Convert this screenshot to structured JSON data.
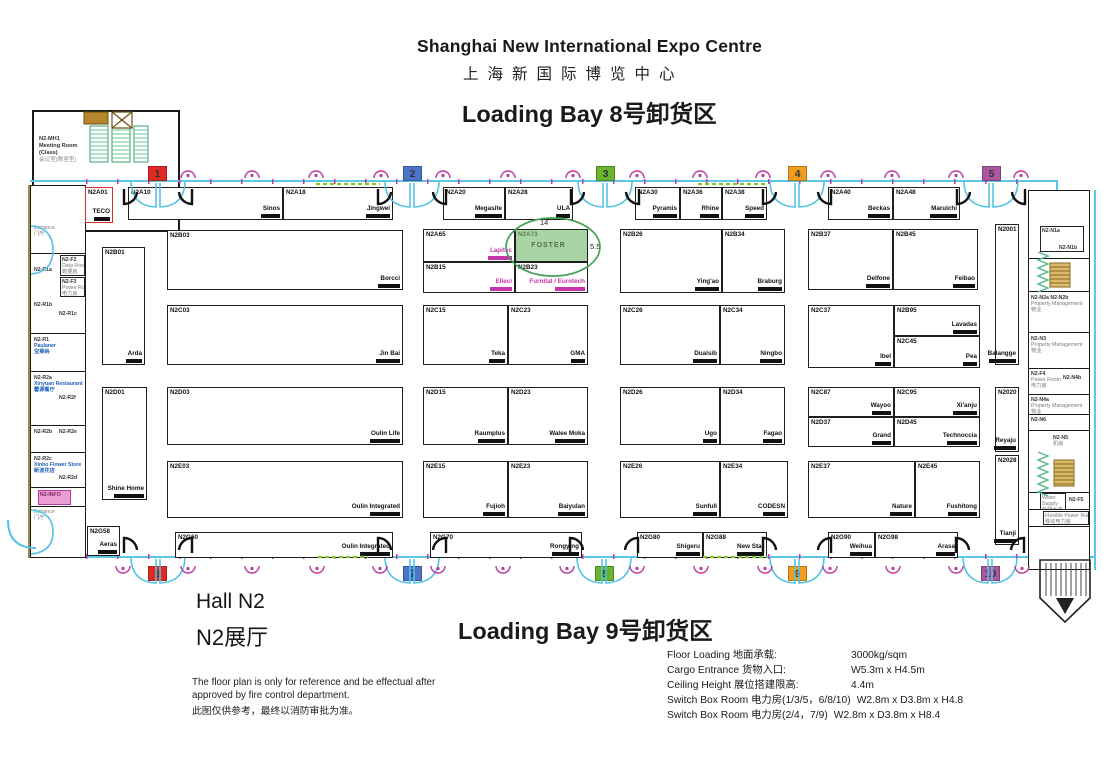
{
  "header": {
    "title_en": "Shanghai New International Expo Centre",
    "title_cn": "上海新国际博览中心",
    "bay_top": "Loading Bay 8号卸货区",
    "bay_bottom": "Loading Bay 9号卸货区"
  },
  "hall": {
    "en": "Hall N2",
    "cn": "N2展厅"
  },
  "disclaimer": {
    "en1": "The floor plan is only for reference and be effectual after",
    "en2": "approved by fire control department.",
    "cn": "此图仅供参考，最终以消防审批为准。"
  },
  "specs": [
    {
      "label": "Floor Loading 地面承载:",
      "value": "3000kg/sqm"
    },
    {
      "label": "Cargo Entrance 货物入口:",
      "value": "W5.3m x H4.5m"
    },
    {
      "label": "Ceiling Height 展位搭建限高:",
      "value": "4.4m"
    },
    {
      "label": "Switch Box Room 电力房(1/3/5，6/8/10)",
      "value": "W2.8m x D3.8m x H4.8"
    },
    {
      "label": "Switch Box Room 电力房(2/4，7/9)",
      "value": "W2.8m x D3.8m x H8.4"
    }
  ],
  "highlight": {
    "booth": "N2A73",
    "exhibitor": "FOSTER",
    "width_label": "14",
    "depth_label": "5.5",
    "ellipse_color": "#44a054"
  },
  "meeting_room": {
    "id": "N2-MH1",
    "line1": "Meeting Room",
    "line2": "(Class)",
    "line3": "会议室(教室型)"
  },
  "markers": [
    {
      "n": "1",
      "x": 148,
      "y": 166,
      "color": "#e02a23"
    },
    {
      "n": "2",
      "x": 403,
      "y": 166,
      "color": "#4d76c8"
    },
    {
      "n": "3",
      "x": 596,
      "y": 166,
      "color": "#69b52f"
    },
    {
      "n": "4",
      "x": 788,
      "y": 166,
      "color": "#f29d1f"
    },
    {
      "n": "5",
      "x": 982,
      "y": 166,
      "color": "#aa57a0"
    },
    {
      "n": "6",
      "x": 148,
      "y": 566,
      "color": "#e02a23"
    },
    {
      "n": "7",
      "x": 403,
      "y": 566,
      "color": "#4d76c8"
    },
    {
      "n": "8",
      "x": 595,
      "y": 566,
      "color": "#69b52f"
    },
    {
      "n": "9",
      "x": 788,
      "y": 566,
      "color": "#f29d1f"
    },
    {
      "n": "10",
      "x": 981,
      "y": 566,
      "color": "#aa57a0"
    }
  ],
  "booths": [
    {
      "id": "N2A01",
      "name": "TECO",
      "x": 85,
      "y": 187,
      "w": 28,
      "h": 36,
      "border": "#d03028"
    },
    {
      "id": "N2A10",
      "name": "Sinos",
      "x": 128,
      "y": 187,
      "w": 155,
      "h": 33
    },
    {
      "id": "N2A18",
      "name": "Jingwei",
      "x": 283,
      "y": 187,
      "w": 110,
      "h": 33
    },
    {
      "id": "N2A20",
      "name": "Megasite",
      "x": 443,
      "y": 187,
      "w": 62,
      "h": 33
    },
    {
      "id": "N2A28",
      "name": "ULA",
      "x": 505,
      "y": 187,
      "w": 68,
      "h": 33
    },
    {
      "id": "N2A30",
      "name": "Pyramis",
      "x": 635,
      "y": 187,
      "w": 45,
      "h": 33
    },
    {
      "id": "N2A36",
      "name": "Rhine",
      "x": 680,
      "y": 187,
      "w": 42,
      "h": 33
    },
    {
      "id": "N2A38",
      "name": "Speed",
      "x": 722,
      "y": 187,
      "w": 45,
      "h": 33
    },
    {
      "id": "N2A40",
      "name": "Beckas",
      "x": 828,
      "y": 187,
      "w": 65,
      "h": 33
    },
    {
      "id": "N2A48",
      "name": "Maruichi",
      "x": 893,
      "y": 187,
      "w": 67,
      "h": 33
    },
    {
      "id": "N2B01",
      "name": "Arda",
      "x": 102,
      "y": 247,
      "w": 43,
      "h": 118
    },
    {
      "id": "N2B03",
      "name": "Borcci",
      "x": 167,
      "y": 230,
      "w": 236,
      "h": 60
    },
    {
      "id": "N2A65",
      "name": "Lapitec",
      "x": 423,
      "y": 229,
      "w": 92,
      "h": 33,
      "nc": "#c535a5"
    },
    {
      "id": "N2A73",
      "name": "FOSTER",
      "x": 515,
      "y": 229,
      "w": 73,
      "h": 33,
      "bg": "#a9d4a3",
      "idc": "#5f7f5e",
      "nc": "#4f6b55",
      "center": true,
      "noSmudge": true
    },
    {
      "id": "N2B15",
      "name": "Elleci",
      "x": 423,
      "y": 262,
      "w": 92,
      "h": 31,
      "nc": "#c535a5"
    },
    {
      "id": "N2B23",
      "name": "Furnital / Eurotech",
      "x": 515,
      "y": 262,
      "w": 73,
      "h": 31,
      "nc": "#c535a5"
    },
    {
      "id": "N2B26",
      "name": "Ying'ao",
      "x": 620,
      "y": 229,
      "w": 102,
      "h": 64
    },
    {
      "id": "N2B34",
      "name": "Braburg",
      "x": 722,
      "y": 229,
      "w": 63,
      "h": 64
    },
    {
      "id": "N2B37",
      "name": "Delfone",
      "x": 808,
      "y": 229,
      "w": 85,
      "h": 61
    },
    {
      "id": "N2B45",
      "name": "Feibao",
      "x": 893,
      "y": 229,
      "w": 85,
      "h": 61
    },
    {
      "id": "N2001",
      "name": "Balangge",
      "x": 995,
      "y": 224,
      "w": 24,
      "h": 141
    },
    {
      "id": "N2C03",
      "name": "Jin Bai",
      "x": 167,
      "y": 305,
      "w": 236,
      "h": 60
    },
    {
      "id": "N2C15",
      "name": "Teka",
      "x": 423,
      "y": 305,
      "w": 85,
      "h": 60
    },
    {
      "id": "N2C23",
      "name": "GMA",
      "x": 508,
      "y": 305,
      "w": 80,
      "h": 60
    },
    {
      "id": "N2C26",
      "name": "Dualsib",
      "x": 620,
      "y": 305,
      "w": 100,
      "h": 60
    },
    {
      "id": "N2C34",
      "name": "Ningbo",
      "x": 720,
      "y": 305,
      "w": 65,
      "h": 60
    },
    {
      "id": "N2C37",
      "name": "Ibel",
      "x": 808,
      "y": 305,
      "w": 86,
      "h": 63
    },
    {
      "id": "N2B95",
      "name": "Lavadas",
      "x": 894,
      "y": 305,
      "w": 86,
      "h": 31
    },
    {
      "id": "N2C45",
      "name": "Pea",
      "x": 894,
      "y": 336,
      "w": 86,
      "h": 32
    },
    {
      "id": "N2D01",
      "name": "Shine Home",
      "x": 102,
      "y": 387,
      "w": 45,
      "h": 113
    },
    {
      "id": "N2D03",
      "name": "Oulin Life",
      "x": 167,
      "y": 387,
      "w": 236,
      "h": 58
    },
    {
      "id": "N2D15",
      "name": "Raumplus",
      "x": 423,
      "y": 387,
      "w": 85,
      "h": 58
    },
    {
      "id": "N2D23",
      "name": "Walee Moka",
      "x": 508,
      "y": 387,
      "w": 80,
      "h": 58
    },
    {
      "id": "N2D26",
      "name": "Ugo",
      "x": 620,
      "y": 387,
      "w": 100,
      "h": 58
    },
    {
      "id": "N2D34",
      "name": "Fagao",
      "x": 720,
      "y": 387,
      "w": 65,
      "h": 58
    },
    {
      "id": "N2C87",
      "name": "Wayoo",
      "x": 808,
      "y": 387,
      "w": 86,
      "h": 30
    },
    {
      "id": "N2C95",
      "name": "Xi'anju",
      "x": 894,
      "y": 387,
      "w": 86,
      "h": 30
    },
    {
      "id": "N2D37",
      "name": "Grand",
      "x": 808,
      "y": 417,
      "w": 86,
      "h": 30
    },
    {
      "id": "N2D45",
      "name": "Technoccia",
      "x": 894,
      "y": 417,
      "w": 86,
      "h": 30
    },
    {
      "id": "N2020",
      "name": "Reyaju",
      "x": 995,
      "y": 387,
      "w": 24,
      "h": 65
    },
    {
      "id": "N2E03",
      "name": "Oulin Integrated",
      "x": 167,
      "y": 461,
      "w": 236,
      "h": 57
    },
    {
      "id": "N2E15",
      "name": "Fujioh",
      "x": 423,
      "y": 461,
      "w": 85,
      "h": 57
    },
    {
      "id": "N2E23",
      "name": "Baiyulan",
      "x": 508,
      "y": 461,
      "w": 80,
      "h": 57
    },
    {
      "id": "N2E26",
      "name": "Sunfull",
      "x": 620,
      "y": 461,
      "w": 100,
      "h": 57
    },
    {
      "id": "N2E34",
      "name": "CODESN",
      "x": 720,
      "y": 461,
      "w": 68,
      "h": 57
    },
    {
      "id": "N2E37",
      "name": "Nature",
      "x": 808,
      "y": 461,
      "w": 107,
      "h": 57
    },
    {
      "id": "N2E45",
      "name": "Fushitong",
      "x": 915,
      "y": 461,
      "w": 65,
      "h": 57
    },
    {
      "id": "N2028",
      "name": "Tianji",
      "x": 995,
      "y": 455,
      "w": 24,
      "h": 90
    },
    {
      "id": "N2G58",
      "name": "Aeras",
      "x": 87,
      "y": 526,
      "w": 33,
      "h": 30
    },
    {
      "id": "N2G60",
      "name": "Oulin Integrated",
      "x": 175,
      "y": 532,
      "w": 218,
      "h": 26
    },
    {
      "id": "N2G70",
      "name": "Rongying",
      "x": 430,
      "y": 532,
      "w": 152,
      "h": 26
    },
    {
      "id": "N2G80",
      "name": "Shigeru",
      "x": 637,
      "y": 532,
      "w": 66,
      "h": 26
    },
    {
      "id": "N2G88",
      "name": "New Star",
      "x": 703,
      "y": 532,
      "w": 64,
      "h": 26
    },
    {
      "id": "N2G90",
      "name": "Weihua",
      "x": 828,
      "y": 532,
      "w": 47,
      "h": 26
    },
    {
      "id": "N2G98",
      "name": "Arasa",
      "x": 875,
      "y": 532,
      "w": 83,
      "h": 26
    }
  ],
  "rooms": [
    {
      "x": 33,
      "y": 224,
      "w": 50,
      "h": 30,
      "nb": true,
      "lines": [
        {
          "t": "Entrance",
          "c": "m"
        },
        {
          "t": "门厅",
          "c": "m"
        }
      ]
    },
    {
      "x": 60,
      "y": 255,
      "w": 25,
      "h": 21,
      "lines": [
        {
          "t": "N2-F2"
        },
        {
          "t": "Data Room",
          "c": "m"
        },
        {
          "t": "数据房",
          "c": "m"
        }
      ]
    },
    {
      "x": 60,
      "y": 277,
      "w": 25,
      "h": 20,
      "lines": [
        {
          "t": "N2-F3"
        },
        {
          "t": "Power Room",
          "c": "m"
        },
        {
          "t": "电力房",
          "c": "m"
        }
      ]
    },
    {
      "x": 33,
      "y": 266,
      "w": 26,
      "h": 11,
      "nb": true,
      "lines": [
        {
          "t": "N2-R1a"
        }
      ]
    },
    {
      "x": 33,
      "y": 301,
      "w": 26,
      "h": 11,
      "nb": true,
      "lines": [
        {
          "t": "N2-R1b"
        }
      ]
    },
    {
      "x": 58,
      "y": 310,
      "w": 26,
      "h": 11,
      "nb": true,
      "lines": [
        {
          "t": "N2-R1c"
        }
      ]
    },
    {
      "x": 33,
      "y": 336,
      "w": 50,
      "h": 30,
      "nb": true,
      "lines": [
        {
          "t": "N2-R1"
        },
        {
          "t": "Paulaner",
          "c": "b"
        },
        {
          "t": "宝莱纳",
          "c": "b"
        }
      ]
    },
    {
      "x": 33,
      "y": 374,
      "w": 52,
      "h": 26,
      "nb": true,
      "lines": [
        {
          "t": "N2-R2a"
        },
        {
          "t": "Xinyuan Restaurant",
          "c": "b"
        },
        {
          "t": "馨源餐厅",
          "c": "b"
        }
      ]
    },
    {
      "x": 58,
      "y": 394,
      "w": 26,
      "h": 11,
      "nb": true,
      "lines": [
        {
          "t": "N2-R2f"
        }
      ]
    },
    {
      "x": 33,
      "y": 428,
      "w": 26,
      "h": 11,
      "nb": true,
      "lines": [
        {
          "t": "N2-R2b"
        }
      ]
    },
    {
      "x": 58,
      "y": 428,
      "w": 26,
      "h": 11,
      "nb": true,
      "lines": [
        {
          "t": "N2-R2e"
        }
      ]
    },
    {
      "x": 33,
      "y": 455,
      "w": 52,
      "h": 22,
      "nb": true,
      "lines": [
        {
          "t": "N2-R2c"
        },
        {
          "t": "Xinbo Flower Store",
          "c": "b"
        },
        {
          "t": "新波花店",
          "c": "b"
        }
      ]
    },
    {
      "x": 58,
      "y": 474,
      "w": 26,
      "h": 11,
      "nb": true,
      "lines": [
        {
          "t": "N2-R2d"
        }
      ]
    },
    {
      "x": 38,
      "y": 490,
      "w": 33,
      "h": 15,
      "info": true,
      "lines": [
        {
          "t": "N2-INFO"
        }
      ]
    },
    {
      "x": 33,
      "y": 508,
      "w": 50,
      "h": 28,
      "nb": true,
      "lines": [
        {
          "t": "Entrance",
          "c": "m"
        },
        {
          "t": "门厅",
          "c": "m"
        }
      ]
    },
    {
      "x": 1040,
      "y": 226,
      "w": 44,
      "h": 26,
      "lines": [
        {
          "t": "N2-N1a"
        }
      ]
    },
    {
      "x": 1058,
      "y": 244,
      "w": 30,
      "h": 11,
      "nb": true,
      "lines": [
        {
          "t": "N2-N1b"
        }
      ]
    },
    {
      "x": 1030,
      "y": 294,
      "w": 58,
      "h": 36,
      "nb": true,
      "lines": [
        {
          "t": "N2-N2a  N2-N2b"
        },
        {
          "t": "Property Management",
          "c": "m"
        },
        {
          "t": "物业",
          "c": "m"
        }
      ]
    },
    {
      "x": 1030,
      "y": 335,
      "w": 58,
      "h": 31,
      "nb": true,
      "lines": [
        {
          "t": "N2-N3"
        },
        {
          "t": "Property Management",
          "c": "m"
        },
        {
          "t": "物业",
          "c": "m"
        }
      ]
    },
    {
      "x": 1030,
      "y": 370,
      "w": 31,
      "h": 23,
      "nb": true,
      "lines": [
        {
          "t": "N2-F4"
        },
        {
          "t": "Power Room",
          "c": "m"
        },
        {
          "t": "电力房",
          "c": "m"
        }
      ]
    },
    {
      "x": 1062,
      "y": 374,
      "w": 28,
      "h": 11,
      "nb": true,
      "lines": [
        {
          "t": "N2-N4b"
        }
      ]
    },
    {
      "x": 1030,
      "y": 396,
      "w": 58,
      "h": 18,
      "nb": true,
      "lines": [
        {
          "t": "N2-N4a"
        },
        {
          "t": "Property Management",
          "c": "m"
        },
        {
          "t": "物业",
          "c": "m"
        }
      ]
    },
    {
      "x": 1030,
      "y": 416,
      "w": 26,
      "h": 11,
      "nb": true,
      "lines": [
        {
          "t": "N2-N6"
        }
      ]
    },
    {
      "x": 1052,
      "y": 434,
      "w": 26,
      "h": 17,
      "nb": true,
      "lines": [
        {
          "t": "N2-N5"
        },
        {
          "t": "机房",
          "c": "m"
        }
      ]
    },
    {
      "x": 1040,
      "y": 493,
      "w": 26,
      "h": 17,
      "lines": [
        {
          "t": "Water",
          "c": "m"
        },
        {
          "t": "Supply",
          "c": "m"
        },
        {
          "t": "给排水房",
          "c": "m"
        }
      ]
    },
    {
      "x": 1068,
      "y": 496,
      "w": 22,
      "h": 11,
      "nb": true,
      "lines": [
        {
          "t": "N2-F5"
        }
      ]
    },
    {
      "x": 1043,
      "y": 511,
      "w": 46,
      "h": 14,
      "lines": [
        {
          "t": "Flexible Power Room",
          "c": "m"
        },
        {
          "t": "移动电力房",
          "c": "m"
        }
      ]
    }
  ]
}
